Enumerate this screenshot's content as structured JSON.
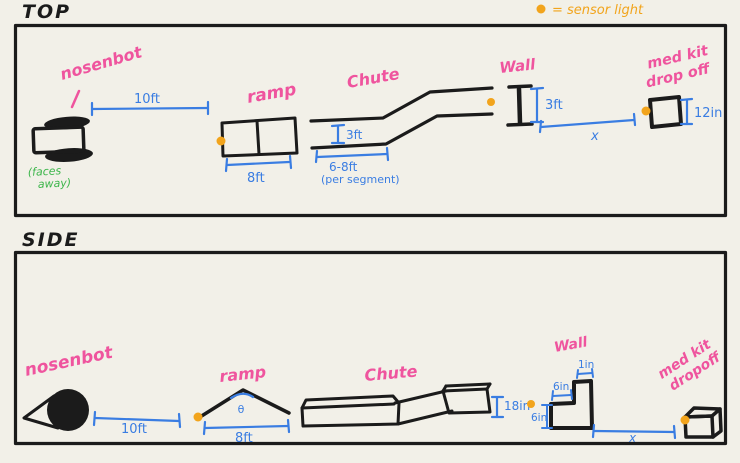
{
  "colors": {
    "paper": "#f2f0e8",
    "ink": "#1b1b1b",
    "pink": "#ef549e",
    "blue": "#3a7de2",
    "orange": "#f2a41c",
    "green": "#3cb54a"
  },
  "titles": {
    "top": "TOP",
    "side": "SIDE"
  },
  "legend": {
    "label": "= sensor light"
  },
  "top_view": {
    "nosenbot": "nosenbot",
    "faces_away_l1": "(faces",
    "faces_away_l2": "away)",
    "ramp": "ramp",
    "chute": "Chute",
    "wall": "Wall",
    "medkit_l1": "med kit",
    "medkit_l2": "drop off",
    "dims": {
      "d10ft": "10ft",
      "d8ft": "8ft",
      "d3ft_chute": "3ft",
      "d6_8ft": "6-8ft",
      "per_segment": "(per segment)",
      "d3ft_wall": "3ft",
      "x": "x",
      "d12in": "12in"
    }
  },
  "side_view": {
    "nosenbot": "nosenbot",
    "ramp": "ramp",
    "chute": "Chute",
    "wall": "Wall",
    "medkit_l1": "med kit",
    "medkit_l2": "dropoff",
    "dims": {
      "d10ft": "10ft",
      "theta": "θ",
      "d8ft": "8ft",
      "d18in": "18in",
      "d6in_h": "6in",
      "d6in_w": "6in",
      "d1in": "1in",
      "x": "x"
    }
  }
}
